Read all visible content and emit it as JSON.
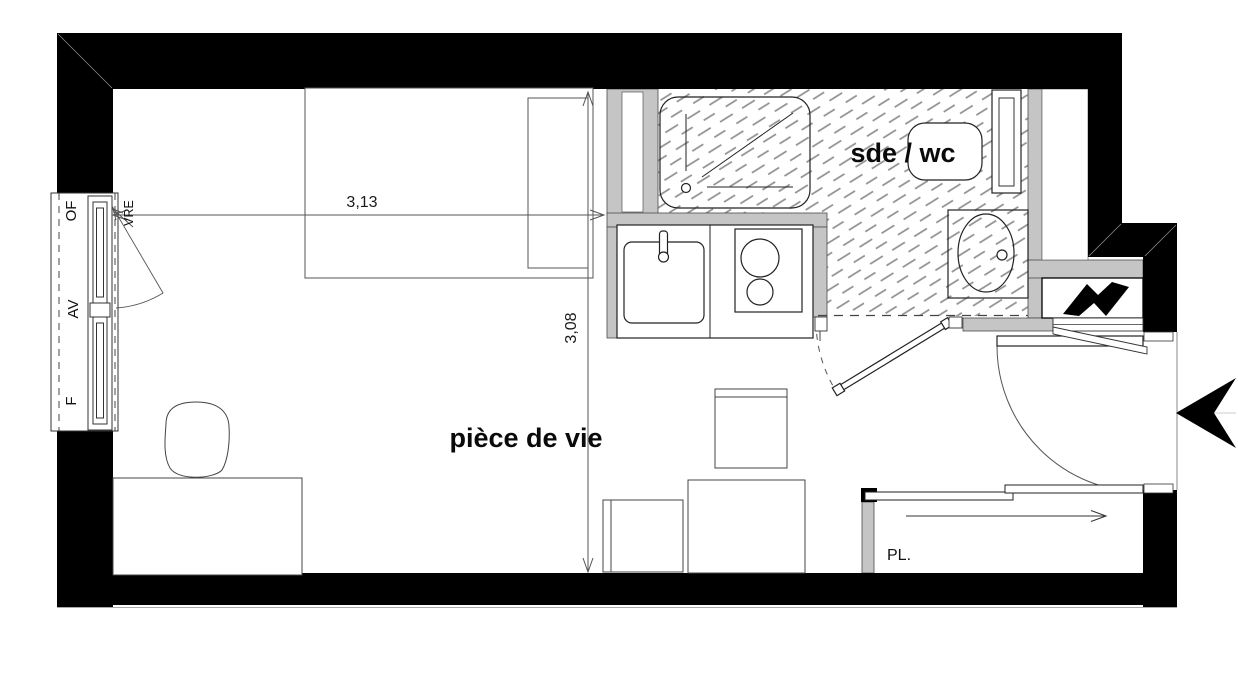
{
  "plan": {
    "rooms": {
      "living": "pièce de vie",
      "bathroom": "sde / wc",
      "closet": "PL."
    },
    "dimensions": {
      "horizontal": "3,13",
      "vertical": "3,08"
    },
    "window_labels": {
      "of": "OF",
      "av": "AV",
      "f": "F",
      "vre": "VRE"
    },
    "symbols": {
      "electrical_panel": "lightning-bolt-icon",
      "entrance": "entry-arrow-icon"
    },
    "colors": {
      "wall": "#000000",
      "partition": "#c5c5c5",
      "hatch": "#8f8f8f",
      "outline": "#333333",
      "dim": "#555555"
    }
  }
}
